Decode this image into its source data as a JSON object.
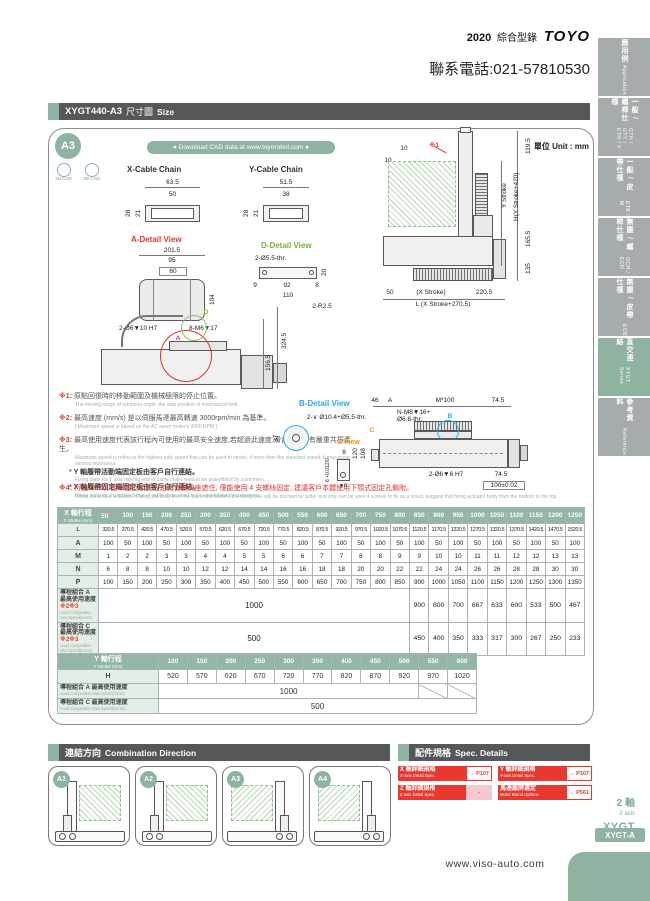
{
  "colors": {
    "accent_green": "#8fb3a1",
    "bar_dark": "#54585a",
    "red": "#e8382f"
  },
  "page": {
    "year": "2020",
    "catalog": "綜合型錄",
    "brand": "TOYO",
    "phone": "聯系電話:021-57810530",
    "url": "www.viso-auto.com"
  },
  "sidebar": {
    "tabs": [
      {
        "zh": "應用例",
        "en": "Application",
        "active": false
      },
      {
        "zh": "一般 / 螺桿仕樣",
        "en": "GTH / GTY / ETH / Y",
        "active": false
      },
      {
        "zh": "一般 / 皮帶仕樣",
        "en": "ETB / M",
        "active": false
      },
      {
        "zh": "無塵 / 螺桿仕樣",
        "en": "GCH / ECH",
        "active": false
      },
      {
        "zh": "無塵 / 皮帶仕樣",
        "en": "ECB",
        "active": false
      },
      {
        "zh": "直交連結",
        "en": "XYGT Series",
        "active": true
      },
      {
        "zh": "參考資料",
        "en": "Reference",
        "active": false
      }
    ]
  },
  "header": {
    "model": "XYGT440-A3",
    "title_zh": "尺寸圖",
    "title_en": "Size"
  },
  "cad": {
    "badge": "A3",
    "b2d": "2D CAD",
    "b3d": "3D CAD",
    "download": "● Download CAD data at www.toyorobot.com ●",
    "unit": "單位 Unit : mm"
  },
  "views": {
    "x_chain": {
      "title": "X-Cable Chain",
      "w_outer": "63.5",
      "w_inner": "50",
      "h_inner": "21",
      "h_outer": "28"
    },
    "y_chain": {
      "title": "Y-Cable Chain",
      "w_outer": "51.5",
      "w_inner": "38",
      "h_inner": "21",
      "h_outer": "28"
    },
    "a_detail": {
      "title": "A-Detail View",
      "w1": "201.5",
      "w2": "95",
      "w3": "60",
      "h": "104",
      "hole1": "2-Ø6▼10 H7",
      "hole2": "8-M6▼17"
    },
    "d_detail": {
      "title": "D-Detail View",
      "hole": "2-Ø5.5-thr.",
      "d9": "9",
      "d92": "92",
      "d8": "8",
      "d110": "110",
      "r": "2-R2.5",
      "d20": "20"
    },
    "front": {
      "note": "※1",
      "t10a": "10",
      "t10b": "10",
      "d1195": "119.5",
      "ystroke": "Y Stroke",
      "h": "H(Y Stroke+420)",
      "d1655": "165.5",
      "d135": "135",
      "d50": "50",
      "xstroke": "(X Stroke)",
      "d2205": "220.5",
      "l": "L (X Stroke+270.5)"
    },
    "side": {
      "d3245": "324.5",
      "d1565": "156.5",
      "a": "A",
      "d": "D"
    },
    "b_detail": {
      "title": "B-Detail View",
      "hole": "2-∨ Ø10.4+Ø5.5-thr.",
      "d37": "37",
      "b": "B"
    },
    "c_view": {
      "title": "C View",
      "d8": "8",
      "tol": "6 +0.012/0",
      "depth": "▼6"
    },
    "xaxis": {
      "d46": "46",
      "a": "A",
      "m100": "M*100",
      "d745a": "74.5",
      "nm8a": "N-M8▼16+",
      "nm8b": "Ø6.8-thr.",
      "b": "B",
      "c": "C",
      "d120": "120",
      "d108": "108",
      "hole": "2-Ø6▼6 H7",
      "d745b": "74.5",
      "d100": "100±0.02"
    }
  },
  "notes": [
    {
      "no": "※1:",
      "zh": "原點回復時的移動範圍及機械極限的停止位置。",
      "en": "The moving range of returning origin, the stop position of mechanical limit."
    },
    {
      "no": "※2:",
      "zh": "最高速度 (mm/s) 是以伺服馬達最高轉速 3000rpm/min 為基準。",
      "en": "[ Maximum speed is based on the AC servo motor's 3000 RPM ]"
    },
    {
      "no": "※3:",
      "zh": "最高使用速度代表該行程內可使用的最高安全速度,若超過此速度,滑台可能會有嚴重共振產生。",
      "en": "Maximum speed is refers to the highest safe speed that can be used in stroke, if more than the standard speed, it may occur serious resonance.",
      "sub": [
        {
          "st": "*",
          "zh": "Y 軸履帶活動端固定板由客戶自行連結。",
          "en": "Fixing plate for Y axis moving end of cable chain need to be assembled by customers."
        },
        {
          "st": "*",
          "zh": "X 軸履帶固定端固定板由客戶自行連結。",
          "en": "Fixing plate for X axis fixed end of cable chain need to be assembled by customers."
        }
      ]
    },
    {
      "no": "※4:",
      "zh": "行程 50 時, 因本體上顎式固定孔會被滑座遮住, 僅能使用 4 支螺絲固定, 建議客戶本體使用下顎式固定孔鎖附。",
      "en": "When the stroke is 50mm, if fixing the body from the top to the bottom, the fixing hole will be blocked by slider and only can be uses 4 screws to fix as a result, suggest that fixing actuator body from the bottom to the top."
    }
  ],
  "x_table": {
    "title_zh": "X 軸行程",
    "title_en": "X Stroke (mm)",
    "strokes": [
      "50※4",
      "100",
      "150",
      "200",
      "250",
      "300",
      "350",
      "400",
      "450",
      "500",
      "550",
      "600",
      "650",
      "700",
      "750",
      "800",
      "850",
      "900",
      "950",
      "1000",
      "1050",
      "1100",
      "1150",
      "1200",
      "1250"
    ],
    "rows": [
      {
        "label": "L",
        "values": [
          "320.5",
          "370.5",
          "420.5",
          "470.5",
          "520.5",
          "570.5",
          "620.5",
          "670.5",
          "720.5",
          "770.5",
          "820.5",
          "870.5",
          "920.5",
          "970.5",
          "1020.5",
          "1070.5",
          "1120.5",
          "1170.5",
          "1220.5",
          "1270.5",
          "1320.5",
          "1370.5",
          "1420.5",
          "1470.5",
          "1520.5"
        ]
      },
      {
        "label": "A",
        "values": [
          "100",
          "50",
          "100",
          "50",
          "100",
          "50",
          "100",
          "50",
          "100",
          "50",
          "100",
          "50",
          "100",
          "50",
          "100",
          "50",
          "100",
          "50",
          "100",
          "50",
          "100",
          "50",
          "100",
          "50",
          "100"
        ]
      },
      {
        "label": "M",
        "values": [
          "1",
          "2",
          "2",
          "3",
          "3",
          "4",
          "4",
          "5",
          "5",
          "6",
          "6",
          "7",
          "7",
          "8",
          "8",
          "9",
          "9",
          "10",
          "10",
          "11",
          "11",
          "12",
          "12",
          "13",
          "13"
        ]
      },
      {
        "label": "N",
        "values": [
          "6",
          "8",
          "8",
          "10",
          "10",
          "12",
          "12",
          "14",
          "14",
          "16",
          "16",
          "18",
          "18",
          "20",
          "20",
          "22",
          "22",
          "24",
          "24",
          "26",
          "26",
          "28",
          "28",
          "30",
          "30"
        ]
      },
      {
        "label": "P",
        "values": [
          "100",
          "150",
          "200",
          "250",
          "300",
          "350",
          "400",
          "450",
          "500",
          "550",
          "600",
          "650",
          "700",
          "750",
          "800",
          "850",
          "900",
          "1000",
          "1050",
          "1100",
          "1150",
          "1200",
          "1250",
          "1300",
          "1350"
        ]
      }
    ],
    "speed_rows": [
      {
        "label_zh": "導程組合 A",
        "label_zh2": "最高使用速度 ※2※3",
        "label_en": "Lead Composition Max.Speed(mm/s)",
        "span_value": "1000",
        "span": 16,
        "tail": [
          "900",
          "800",
          "700",
          "667",
          "633",
          "600",
          "533",
          "500",
          "467"
        ]
      },
      {
        "label_zh": "導程組合 C",
        "label_zh2": "最高使用速度 ※2※3",
        "label_en": "Lead Composition Max.Speed(mm/s)",
        "span_value": "500",
        "span": 16,
        "tail": [
          "450",
          "400",
          "350",
          "333",
          "317",
          "300",
          "267",
          "250",
          "233"
        ]
      }
    ]
  },
  "y_table": {
    "title_zh": "Y 軸行程",
    "title_en": "Y Stroke (mm)",
    "strokes": [
      "100",
      "150",
      "200",
      "250",
      "300",
      "350",
      "400",
      "450",
      "500",
      "550",
      "600"
    ],
    "rows": [
      {
        "label": "H",
        "values": [
          "520",
          "570",
          "620",
          "670",
          "720",
          "770",
          "820",
          "870",
          "920",
          "970",
          "1020"
        ]
      }
    ],
    "speed_rows": [
      {
        "label_zh": "導程組合 A 最高使用速度",
        "label_en": "Lead Composition Max.Speed(mm/s)",
        "span_value": "1000",
        "span": 9,
        "slash": 2
      },
      {
        "label_zh": "導程組合 C 最高使用速度",
        "label_en": "Lead Composition Max.Speed(mm/s)",
        "span_value": "500",
        "span": 11,
        "slash": 0
      }
    ]
  },
  "combination": {
    "title_zh": "連結方向",
    "title_en": "Combination Direction",
    "options": [
      "A1",
      "A2",
      "A3",
      "A4"
    ]
  },
  "spec": {
    "title_zh": "配件規格",
    "title_en": "Spec. Details",
    "items": [
      {
        "zh": "X 軸詳細規格",
        "en": "X-axis Detail Spec.",
        "ref": "→ P107",
        "ref_style": "link"
      },
      {
        "zh": "Y 軸詳細規格",
        "en": "Y-axis Detail Spec.",
        "ref": "→ P107",
        "ref_style": "link"
      },
      {
        "zh": "Z 軸詳細規格",
        "en": "Z-axis Detail Spec.",
        "ref": "-",
        "ref_style": "none"
      },
      {
        "zh": "馬達廠牌選定",
        "en": "Motor Brand Options.",
        "ref": "→ P561",
        "ref_style": "link"
      }
    ]
  },
  "footer": {
    "axes_zh": "2 軸",
    "axes_en": "2 axis",
    "series": "XYGT",
    "tab": "XYGT-A"
  }
}
